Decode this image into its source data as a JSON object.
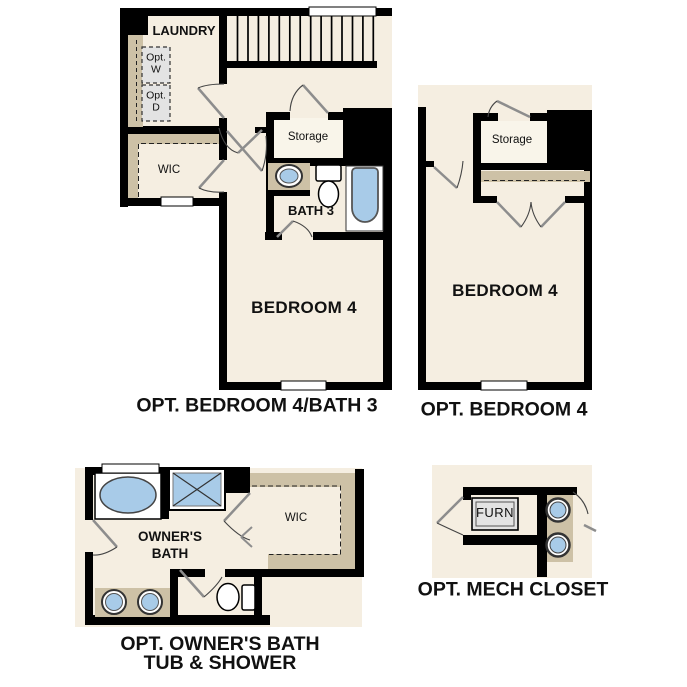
{
  "colors": {
    "background": "#ffffff",
    "floor_cream": "#f5eee1",
    "interior_white": "#f9f5ea",
    "closet_tan": "#cdc1a6",
    "fixture_blue": "#a8cbe8",
    "appliance_gray": "#e3e3e3",
    "wall_black": "#000000",
    "door_leaf_gray": "#8d8d8d"
  },
  "plans": {
    "bedroom4_bath3": {
      "caption": "OPT. BEDROOM 4/BATH 3",
      "labels": {
        "laundry": "LAUNDRY",
        "opt_washer_line1": "Opt.",
        "opt_washer_line2": "W",
        "opt_dryer_line1": "Opt.",
        "opt_dryer_line2": "D",
        "wic": "WIC",
        "storage": "Storage",
        "bath": "BATH 3",
        "bedroom": "BEDROOM 4"
      }
    },
    "bedroom4": {
      "caption": "OPT. BEDROOM 4",
      "labels": {
        "storage": "Storage",
        "bedroom": "BEDROOM 4"
      }
    },
    "owners_bath": {
      "caption_line1": "OPT. OWNER'S BATH",
      "caption_line2": "TUB & SHOWER",
      "labels": {
        "owners_bath_line1": "OWNER'S",
        "owners_bath_line2": "BATH",
        "wic": "WIC"
      }
    },
    "mech_closet": {
      "caption": "OPT. MECH CLOSET",
      "labels": {
        "furnace": "FURN"
      }
    }
  }
}
